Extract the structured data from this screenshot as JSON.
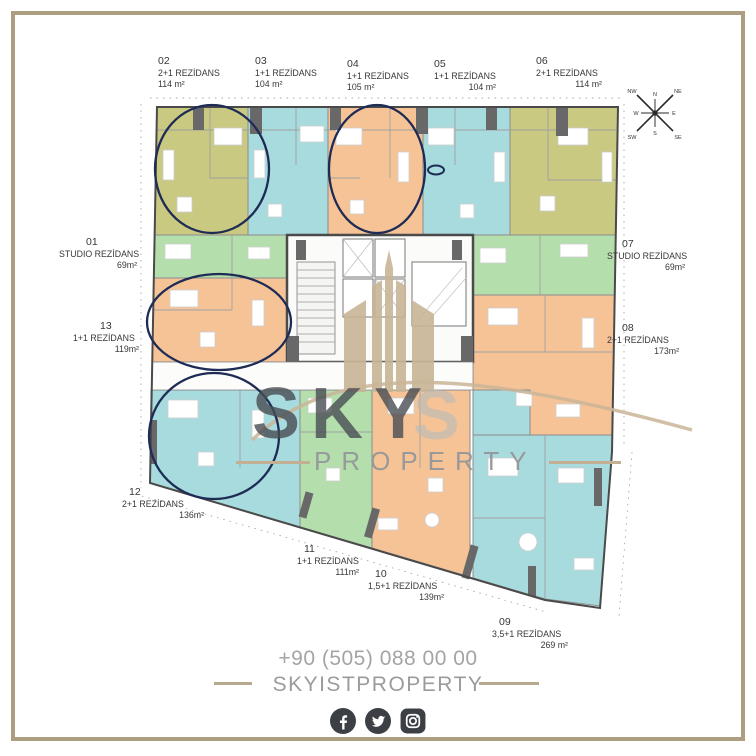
{
  "units": [
    {
      "no": "01",
      "type": "STUDIO REZİDANS",
      "area": "69m²",
      "color": "#b4dfad",
      "circled": false
    },
    {
      "no": "02",
      "type": "2+1 REZİDANS",
      "area": "114 m²",
      "color": "#c9c981",
      "circled": true
    },
    {
      "no": "03",
      "type": "1+1 REZİDANS",
      "area": "104 m²",
      "color": "#a7dbde",
      "circled": false
    },
    {
      "no": "04",
      "type": "1+1 REZİDANS",
      "area": "105 m²",
      "color": "#f6c397",
      "circled": true
    },
    {
      "no": "05",
      "type": "1+1 REZİDANS",
      "area": "104 m²",
      "color": "#a7dbde",
      "circled": false,
      "marked": true
    },
    {
      "no": "06",
      "type": "2+1 REZİDANS",
      "area": "114 m²",
      "color": "#c9c981",
      "circled": false
    },
    {
      "no": "07",
      "type": "STUDIO REZİDANS",
      "area": "69m²",
      "color": "#b4dfad",
      "circled": false
    },
    {
      "no": "08",
      "type": "2+1 REZİDANS",
      "area": "173m²",
      "color": "#f6c397",
      "circled": false
    },
    {
      "no": "09",
      "type": "3,5+1 REZİDANS",
      "area": "269 m²",
      "color": "#a7dbde",
      "circled": false
    },
    {
      "no": "10",
      "type": "1,5+1 REZİDANS",
      "area": "139m²",
      "color": "#f6c397",
      "circled": false
    },
    {
      "no": "11",
      "type": "1+1 REZİDANS",
      "area": "111m²",
      "color": "#b4dfad",
      "circled": false
    },
    {
      "no": "12",
      "type": "2+1 REZİDANS",
      "area": "136m²",
      "color": "#a7dbde",
      "circled": true
    },
    {
      "no": "13",
      "type": "1+1 REZİDANS",
      "area": "119m²",
      "color": "#f6c397",
      "circled": true
    }
  ],
  "watermark": {
    "primary": "SKY",
    "ghost": "S",
    "secondary": "PROPERTY"
  },
  "contact": {
    "phone": "+90 (505) 088 00 00",
    "brand": "SKYISTPROPERTY"
  },
  "social": {
    "icons": [
      "facebook",
      "twitter",
      "instagram"
    ]
  },
  "compass": {
    "points": [
      "N",
      "NE",
      "E",
      "SE",
      "S",
      "SW",
      "W",
      "NW"
    ]
  },
  "colors": {
    "olive": "#c9c981",
    "cyan": "#a7dbde",
    "orange": "#f6c397",
    "green": "#b4dfad",
    "circle_navy": "#1e2c55",
    "frame_tan": "#ad9e82",
    "logo_tan": "#c9b596"
  }
}
